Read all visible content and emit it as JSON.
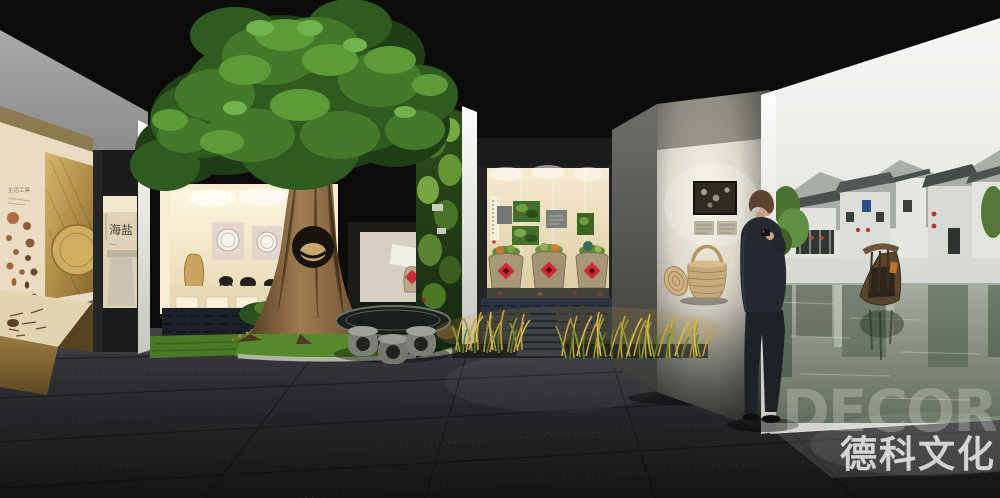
{
  "scene": {
    "type": "exhibition-hall-3d-render",
    "description": "Museum exhibition hall rendering: indoor banyan tree over a lit artifact window, stone table garden, grain jars display, basket display panel, a visitor in a suit, and a Jiangnan water-town mural wall"
  },
  "labels": {
    "left_panel_title": "生活工具",
    "alcove_calligraphy": "海盐"
  },
  "watermark": {
    "logo": "DECOR",
    "name": "德科文化"
  },
  "palette": {
    "ceiling": "#0b0b0a",
    "floor_dark": "#26262a",
    "wall_gray": "#8f8f8d",
    "case_gold": "#b9944e",
    "panel_cream": "#e9dcc2",
    "tree_green": "#3f7029",
    "trunk_brown": "#7a5a3a",
    "grass_green": "#568a2c",
    "jar_stone": "#a89878",
    "label_red": "#cf2b35",
    "mural_sky": "#e9ebe7",
    "water_green": "#7d877a",
    "suit_dark": "#262a30"
  }
}
